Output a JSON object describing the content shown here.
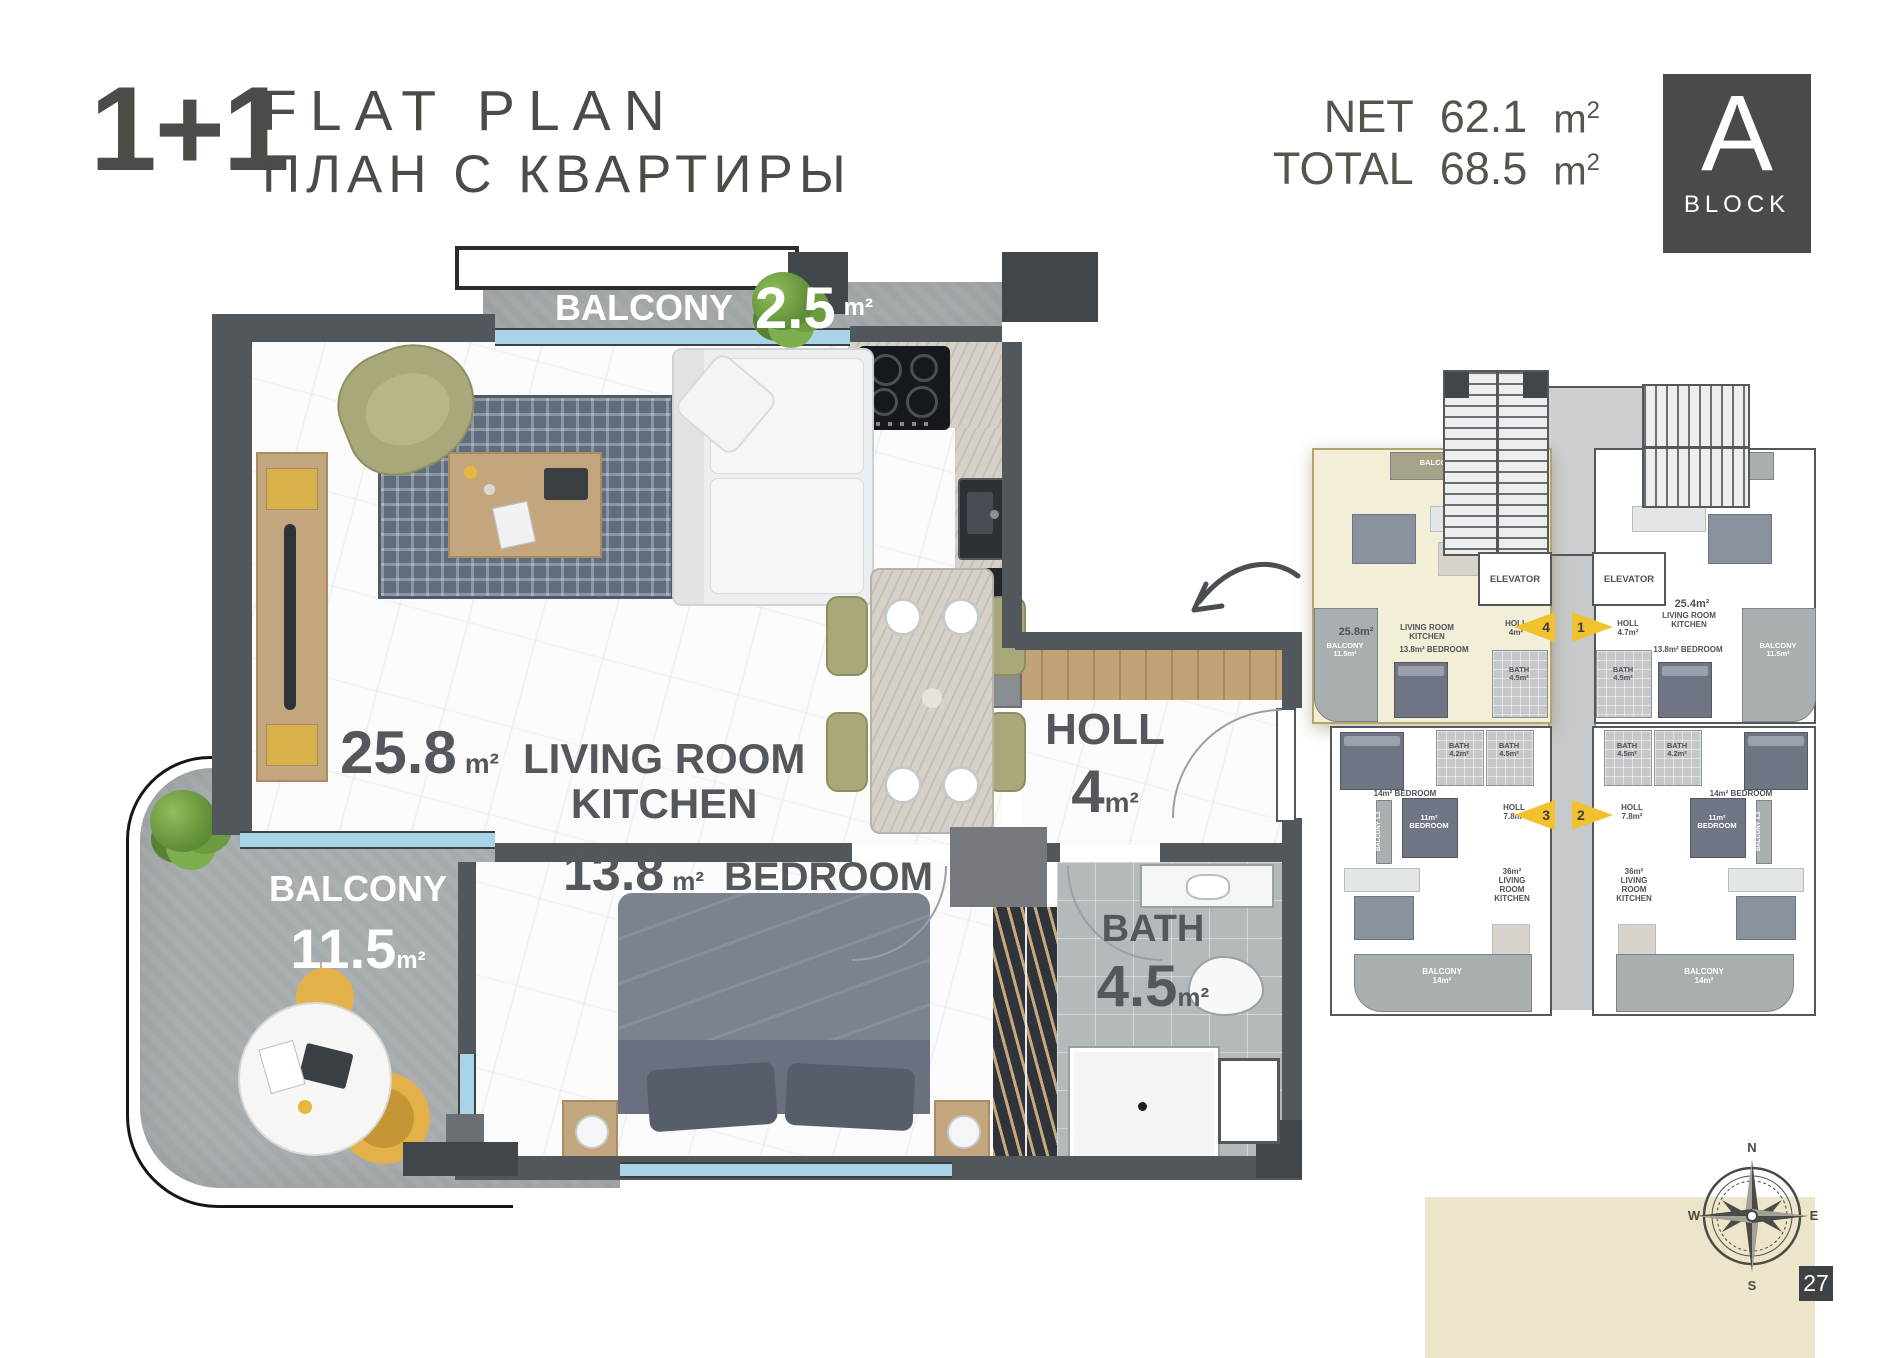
{
  "header": {
    "unit_type": "1+1",
    "title_en": "FLAT PLAN",
    "title_ru": "ПЛАН С КВАРТИРЫ",
    "net_label": "NET",
    "net_value": "62.1",
    "total_label": "TOTAL",
    "total_value": "68.5",
    "area_unit": "m",
    "area_unit_sup": "2",
    "block_letter": "A",
    "block_word": "BLOCK"
  },
  "main_plan": {
    "balcony_top": {
      "label": "BALCONY",
      "value": "2.5",
      "unit": "m²"
    },
    "living": {
      "value": "25.8",
      "unit": "m²",
      "line1": "LIVING ROOM",
      "line2": "KITCHEN"
    },
    "holl": {
      "label": "HOLL",
      "value": "4",
      "unit": "m²"
    },
    "bedroom": {
      "value": "13.8",
      "unit": "m²",
      "label": "BEDROOM"
    },
    "bath": {
      "label": "BATH",
      "value": "4.5",
      "unit": "m²"
    },
    "balcony_side": {
      "label": "BALCONY",
      "value": "11.5",
      "unit": "m²"
    }
  },
  "overview": {
    "elevator_left": "ELEVATOR",
    "elevator_right": "ELEVATOR",
    "markers": {
      "m1": "1",
      "m2": "2",
      "m3": "3",
      "m4": "4"
    },
    "unit_tl": {
      "balcony_top": "BALCONY 2.5m²",
      "area": "25.8m²",
      "room": "LIVING ROOM\nKITCHEN",
      "holl": "HOLL\n4m²",
      "bedroom": "13.8m² BEDROOM",
      "bath": "BATH\n4.5m²",
      "balcony_side": "BALCONY\n11.5m²"
    },
    "unit_tr": {
      "balcony_top": "BALCONY 2.5m²",
      "area": "25.4m²",
      "room": "LIVING ROOM\nKITCHEN",
      "holl": "HOLL\n4.7m²",
      "bedroom": "13.8m² BEDROOM",
      "bath": "BATH\n4.5m²",
      "balcony_side": "BALCONY\n11.5m²"
    },
    "unit_bl": {
      "bath1": "BATH\n4.2m²",
      "bath2": "BATH\n4.5m²",
      "bedroom1": "14m² BEDROOM",
      "bedroom2": "11m²\nBEDROOM",
      "holl": "HOLL\n7.8m²",
      "living": "36m²\nLIVING\nROOM\nKITCHEN",
      "balcony": "BALCONY\n14m²",
      "balcony_side": "BALCONY 1.2"
    },
    "unit_br": {
      "bath1": "BATH\n4.5m²",
      "bath2": "BATH\n4.2m²",
      "bedroom1": "14m² BEDROOM",
      "bedroom2": "11m²\nBEDROOM",
      "holl": "HOLL\n7.8m²",
      "living": "36m²\nLIVING\nROOM\nKITCHEN",
      "balcony": "BALCONY\n14m²",
      "balcony_side": "BALCONY 1.2"
    }
  },
  "compass": {
    "n": "N",
    "e": "E",
    "s": "S",
    "w": "W"
  },
  "page_number": "27",
  "colors": {
    "wall": "#52575c",
    "accent_cream": "#ece5c9",
    "highlight_cream": "#f3eed8",
    "window_blue": "#a9d4e8",
    "marker_yellow": "#f2c22e"
  }
}
